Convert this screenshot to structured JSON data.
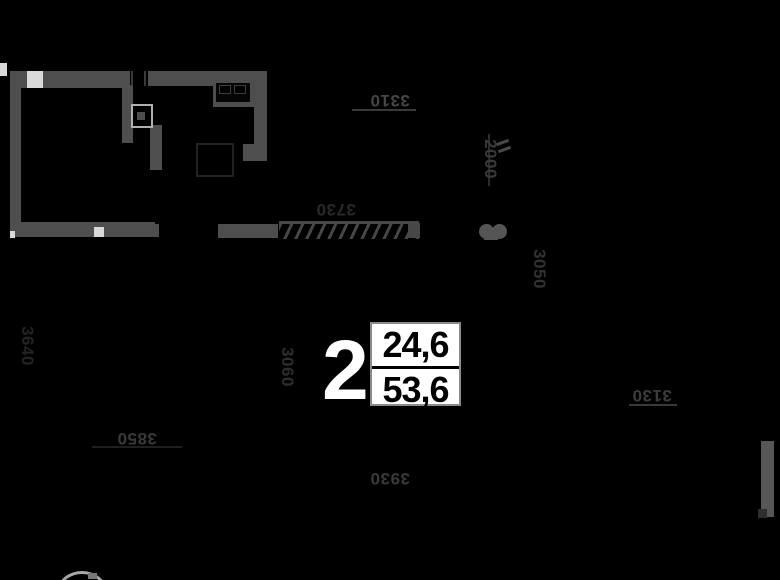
{
  "plan": {
    "room_number": "2",
    "area_table": {
      "upper": "24,6",
      "lower": "53,6"
    },
    "dimensions": {
      "top": "3310",
      "mid": "3730",
      "left_vertical": "3640",
      "center_vertical": "3060",
      "upper_right_vertical": "2000",
      "right_vertical": "3050",
      "bottom_left": "3850",
      "bottom_center": "3930",
      "right": "3130"
    },
    "colors": {
      "background": "#000000",
      "wall": "#4e4e4e",
      "dim_text": "#3a3a3a",
      "area_box_bg": "#ffffff",
      "area_text": "#000000",
      "room_number_color": "#ffffff"
    }
  }
}
